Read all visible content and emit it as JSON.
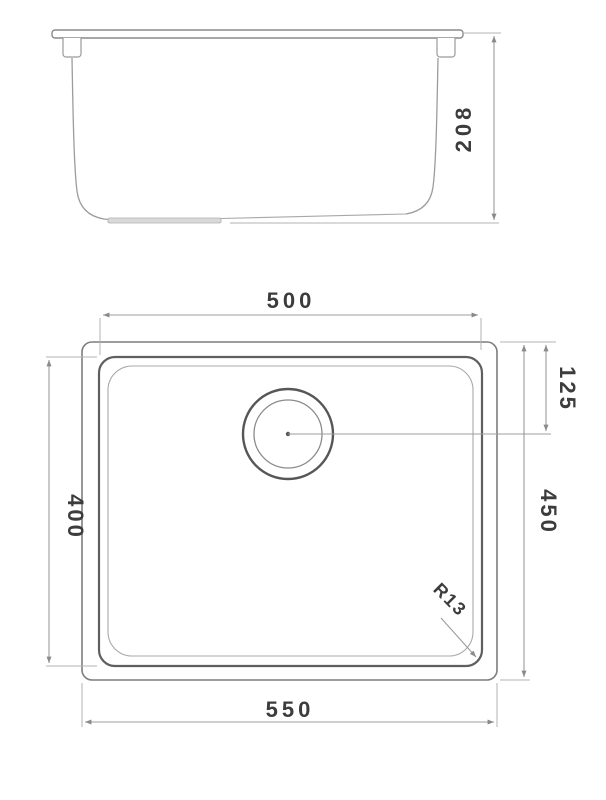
{
  "drawing": {
    "type": "technical-dimension-drawing",
    "subject": "undermount-sink",
    "background_color": "#ffffff",
    "line_color": "#8a8a8a",
    "text_color": "#3c3c3c"
  },
  "side_view": {
    "dimensions": {
      "overall_height": "208"
    }
  },
  "plan_view": {
    "dimensions": {
      "bowl_width": "500",
      "bowl_depth": "400",
      "overall_width": "550",
      "overall_depth": "450",
      "drain_offset_from_top": "125",
      "corner_radius": "R13"
    }
  }
}
